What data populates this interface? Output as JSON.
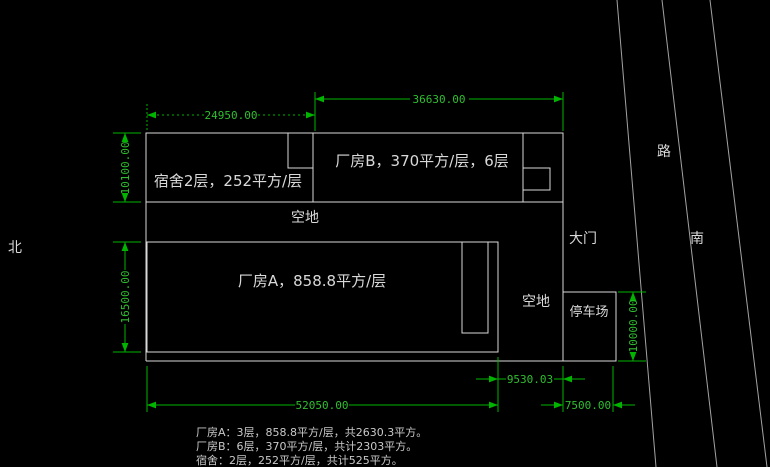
{
  "colors": {
    "background": "#000000",
    "wall_outline": "#d9d9d9",
    "dimension_green": "#00b400",
    "label_white": "#d9d9d9",
    "road_gray": "#a3a3a3"
  },
  "compass": {
    "north": "北"
  },
  "road": {
    "name": "路",
    "south": "南"
  },
  "plan": {
    "dormitory_label": "宿舍2层，252平方/层",
    "factory_b_label": "厂房B，370平方/层，6层",
    "factory_a_label": "厂房A，858.8平方/层",
    "open_space_top": "空地",
    "open_space_right": "空地",
    "gate": "大门",
    "parking": "停车场"
  },
  "dimensions": {
    "factory_b_width": "36630.00",
    "dormitory_width": "24950.00",
    "upper_block_height": "10100.00",
    "factory_a_height": "16500.00",
    "site_width": "52050.00",
    "east_gap": "9530.03",
    "road_setback": "7500.00",
    "parking_height": "10000.00"
  },
  "notes": {
    "factory_a": "厂房A：3层，858.8平方/层，共2630.3平方。",
    "factory_b": "厂房B：6层，370平方/层，共计2303平方。",
    "dormitory": "宿舍：2层，252平方/层，共计525平方。"
  }
}
